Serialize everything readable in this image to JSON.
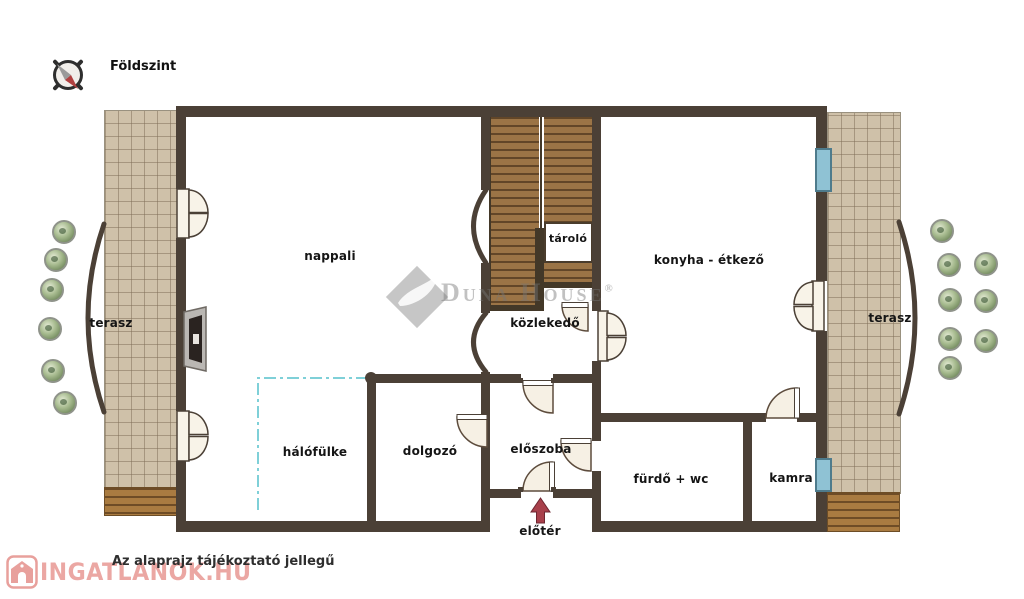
{
  "header": {
    "floor_label": "Földszint"
  },
  "rooms": {
    "nappali": "nappali",
    "tarolo": "tároló",
    "konyha": "konyha - étkező",
    "kozlekedo": "közlekedő",
    "terasz_left": "terasz",
    "terasz_right": "terasz",
    "halofulke": "hálófülke",
    "dolgozo": "dolgozó",
    "eloszoba": "előszoba",
    "furdo": "fürdő + wc",
    "kamra": "kamra",
    "eloter": "előtér"
  },
  "watermark": {
    "brand": "Duna House",
    "registered": "®"
  },
  "footer": {
    "disclaimer": "Az alaprajz tájékoztató jellegű",
    "site": "INGATLANOK.HU"
  },
  "colors": {
    "wall": "#4b4036",
    "stairs_wood": "#9b7446",
    "terrace_tile": "#cfc1a9",
    "deck_wood": "#a97b41",
    "window_blue": "#8fc2d4",
    "partition_dashed": "#7fd0d8",
    "arrow_red": "#a8404b",
    "logo_pink": "#eba7a3",
    "watermark_gray": "#767676"
  }
}
